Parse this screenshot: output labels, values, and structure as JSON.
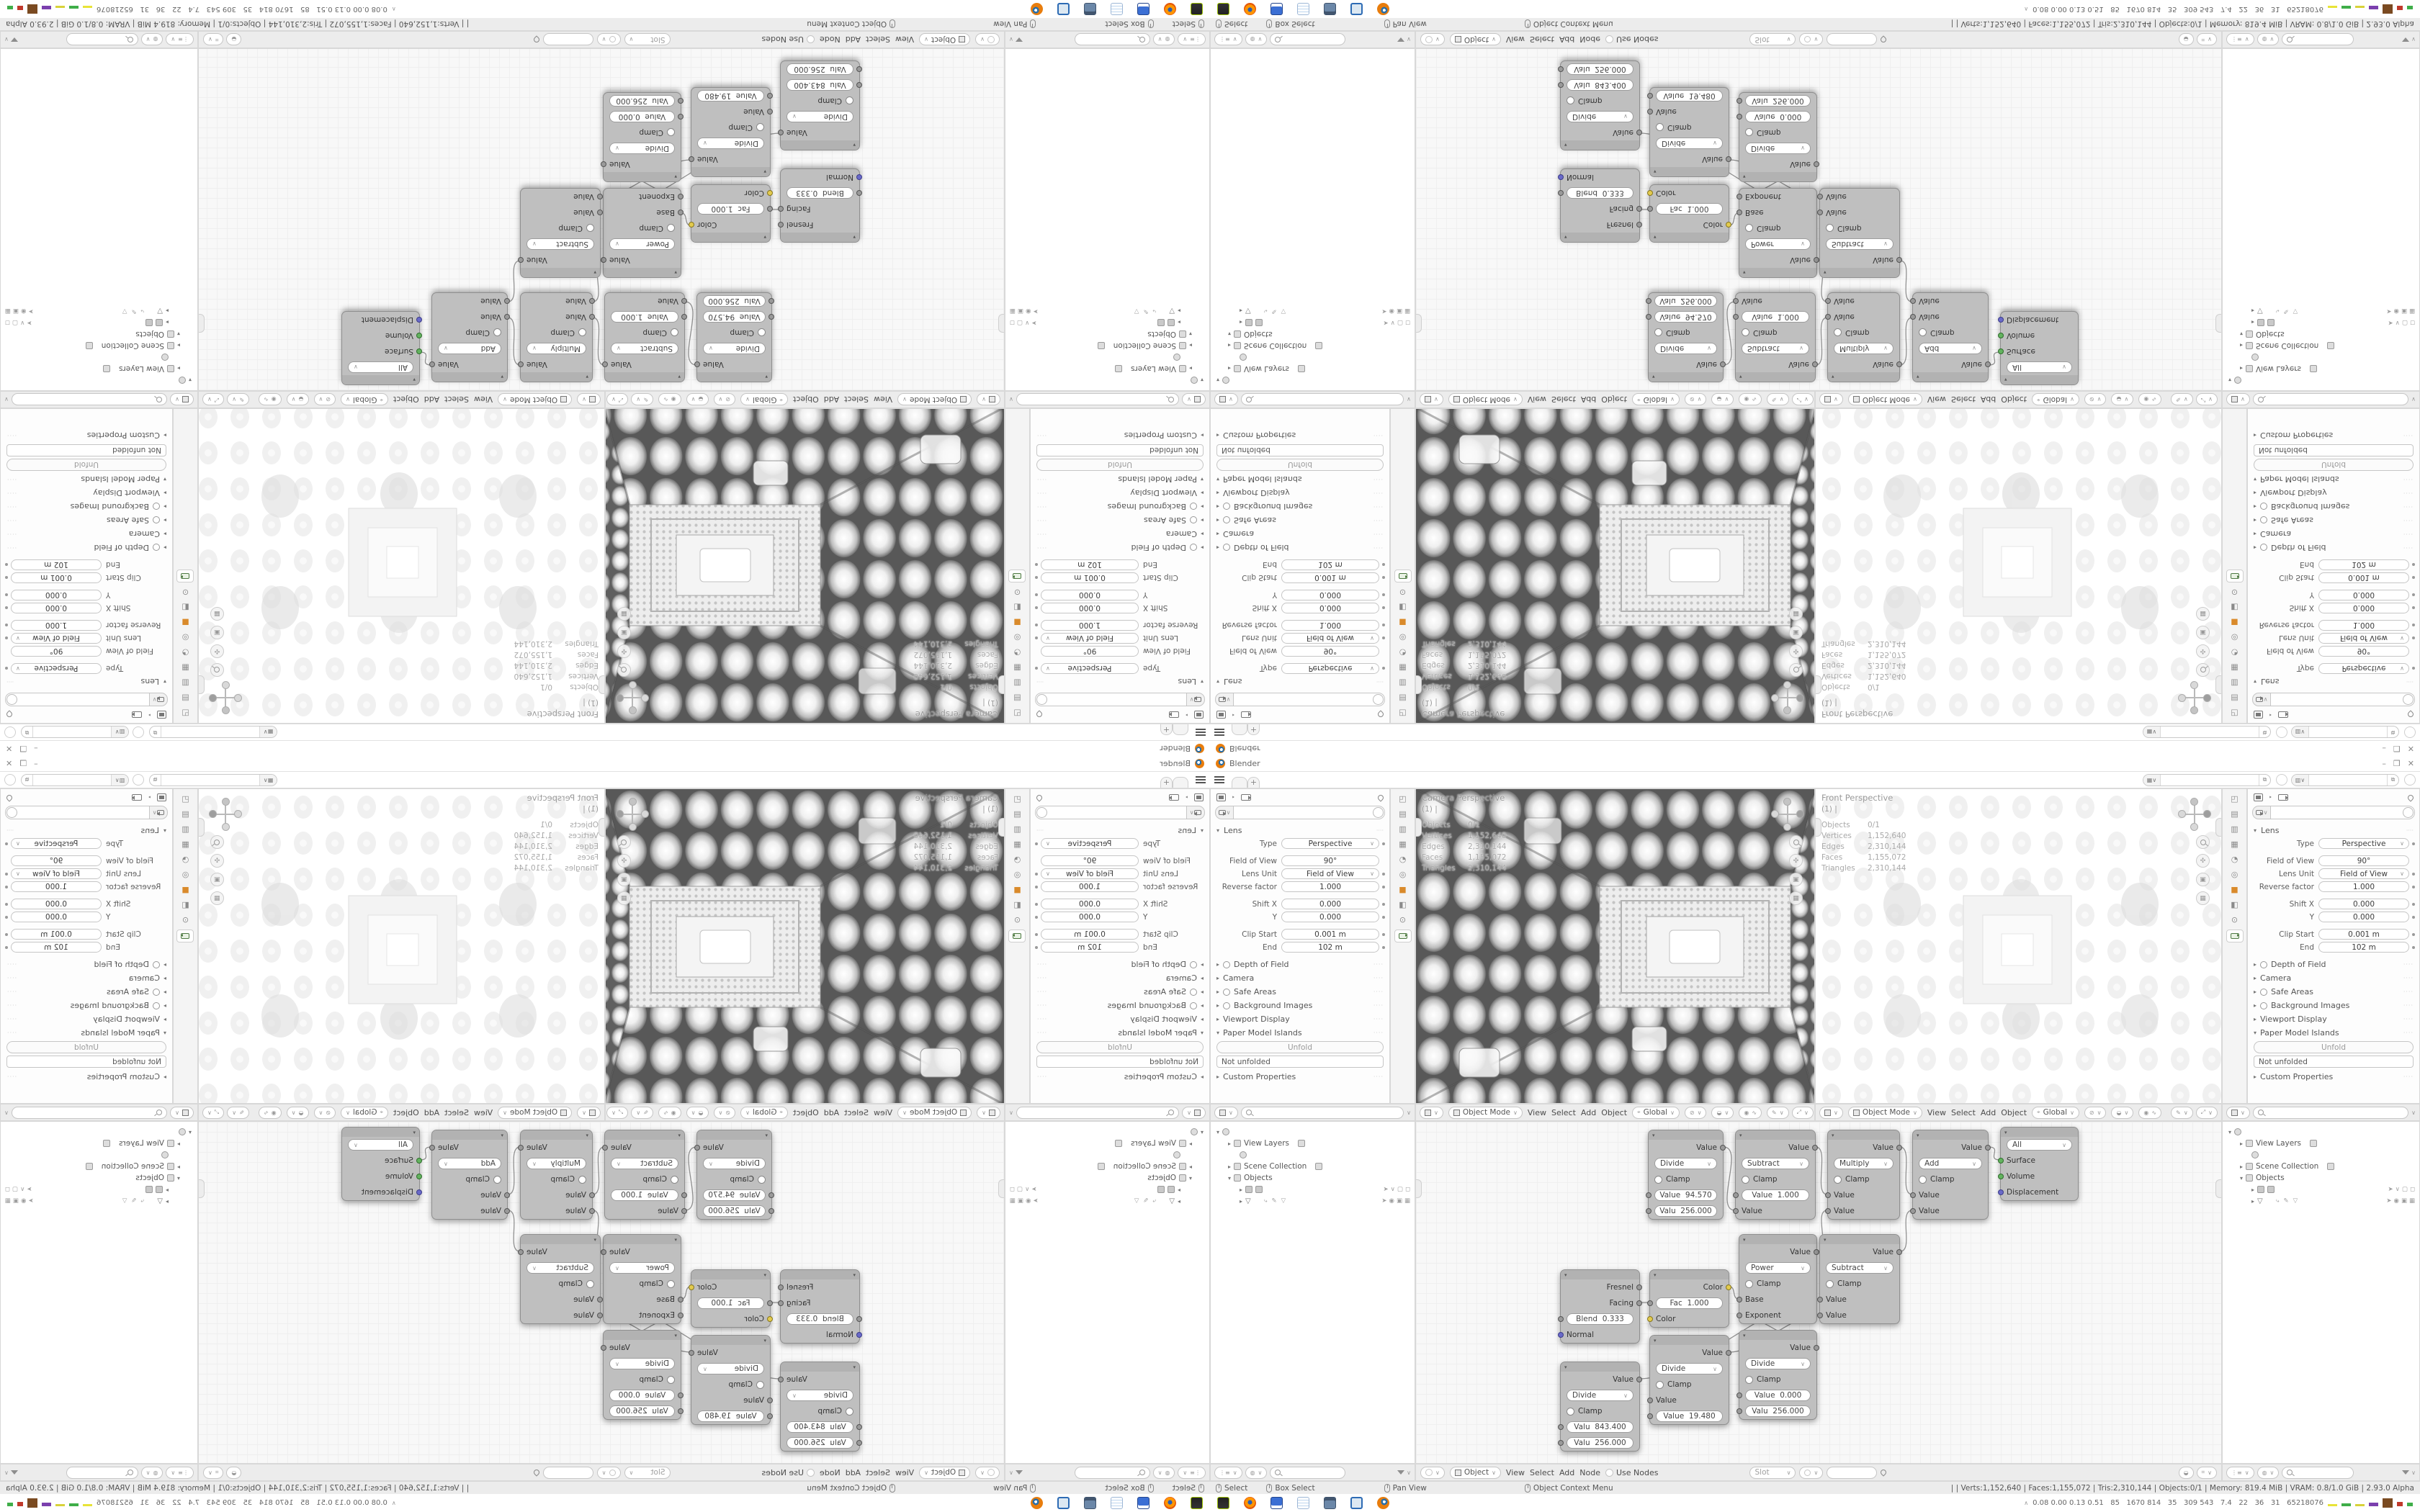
{
  "window": {
    "title": "Blender",
    "min": "–",
    "max": "❒",
    "close": "✕"
  },
  "topbar": {
    "plus": "+",
    "workspace_tabs": 2,
    "scene_selector": "",
    "viewlayer_selector": ""
  },
  "props": {
    "lens": "Lens",
    "rows": [
      {
        "l": "Type",
        "v": "Perspective"
      },
      {
        "l": "Field of View",
        "v": "90°"
      },
      {
        "l": "Lens Unit",
        "v": "Field of View"
      },
      {
        "l": "Reverse factor",
        "v": "1.000"
      },
      {
        "l": "Shift X",
        "v": "0.000"
      },
      {
        "l": "Y",
        "v": "0.000"
      },
      {
        "l": "Clip Start",
        "v": "0.001 m"
      },
      {
        "l": "End",
        "v": "102 m"
      }
    ],
    "sections": {
      "dof": "Depth of Field",
      "camera": "Camera",
      "safe": "Safe Areas",
      "bg": "Background Images",
      "vdisp": "Viewport Display",
      "paper": "Paper Model Islands",
      "custom": "Custom Properties"
    },
    "unfold": "Unfold",
    "not_unfolded": "Not unfolded"
  },
  "viewport": {
    "cam_title": "Camera Perspective",
    "front_title": "Front Perspective",
    "sub": "(1)  |",
    "stats": [
      {
        "k": "Objects",
        "v": "0/1"
      },
      {
        "k": "Vertices",
        "v": "1,152,640"
      },
      {
        "k": "Edges",
        "v": "2,310,144"
      },
      {
        "k": "Faces",
        "v": "1,155,072"
      },
      {
        "k": "Triangles",
        "v": "2,310,144"
      }
    ]
  },
  "vphdr": {
    "mode": "Object Mode",
    "m0": "View",
    "m1": "Select",
    "m2": "Add",
    "m3": "Object",
    "orient": "Global"
  },
  "outliner": {
    "i0": "View Layers",
    "i1": "Scene Collection",
    "i2": "Objects"
  },
  "nfoot": {
    "type": "Object",
    "m0": "View",
    "m1": "Select",
    "m2": "Add",
    "m3": "Node",
    "use": "Use Nodes",
    "slot": "Slot"
  },
  "nodes": {
    "n1": {
      "op": "Divide",
      "out": "Value",
      "clamp": "Clamp",
      "a": "Value  94.570",
      "b": "Valu  256.000"
    },
    "n2": {
      "op": "Subtract",
      "out": "Value",
      "clamp": "Clamp",
      "a": "Value  1.000",
      "b": "Value"
    },
    "n3": {
      "op": "Multiply",
      "out": "Value",
      "clamp": "Clamp",
      "a": "Value",
      "b": "Value"
    },
    "n4": {
      "op": "Add",
      "out": "Value",
      "clamp": "Clamp",
      "a": "Value",
      "b": "Value"
    },
    "n5": {
      "sel": "All",
      "s0": "Surface",
      "s1": "Volume",
      "s2": "Displacement"
    },
    "n6": {
      "o0": "Fresnel",
      "o1": "Facing",
      "a": "Blend  0.333",
      "b": "Normal"
    },
    "n7": {
      "o0": "Color",
      "a": "Fac  1.000",
      "b": "Color"
    },
    "n8": {
      "op": "Power",
      "out": "Value",
      "clamp": "Clamp",
      "a": "Base",
      "b": "Exponent"
    },
    "n9": {
      "op": "Subtract",
      "out": "Value",
      "clamp": "Clamp",
      "a": "Value",
      "b": "Value"
    },
    "n10": {
      "op": "Divide",
      "out": "Value",
      "clamp": "Clamp",
      "a": "Valu  843.400",
      "b": "Valu  256.000"
    },
    "n11": {
      "op": "Divide",
      "out": "Value",
      "clamp": "Clamp",
      "a": "Value",
      "b": "Value  19.480"
    },
    "n12": {
      "op": "Divide",
      "out": "Value",
      "clamp": "Clamp",
      "a": "Value  0.000",
      "b": "Valu  256.000"
    }
  },
  "status": {
    "h0": "Select",
    "h1": "Box Select",
    "h2": "Pan View",
    "h3": "Object Context Menu",
    "stats": "|    | Verts:1,152,640 | Faces:1,155,072 | Tris:2,310,144 | Objects:0/1 | Memory: 819.4 MiB | VRAM: 0.8/1.0 GiB | 2.93.0 Alpha"
  },
  "monitor": {
    "text": "0.08 0.00 0.13 0.51   85   1670 814   35   309 543   7.4   22   36   31   65218076"
  },
  "taskbar_icons": [
    "terminal",
    "firefox",
    "disk64",
    "notepad",
    "window",
    "image-viewer",
    "blender"
  ],
  "colors": {
    "accent_orange": "#e87d0d",
    "node_gray": "#bfbfbf",
    "sock_yellow": "#e3cb4e",
    "sock_blue": "#6a6ac9",
    "sock_green": "#63b35f",
    "chrome": "#ececec"
  }
}
